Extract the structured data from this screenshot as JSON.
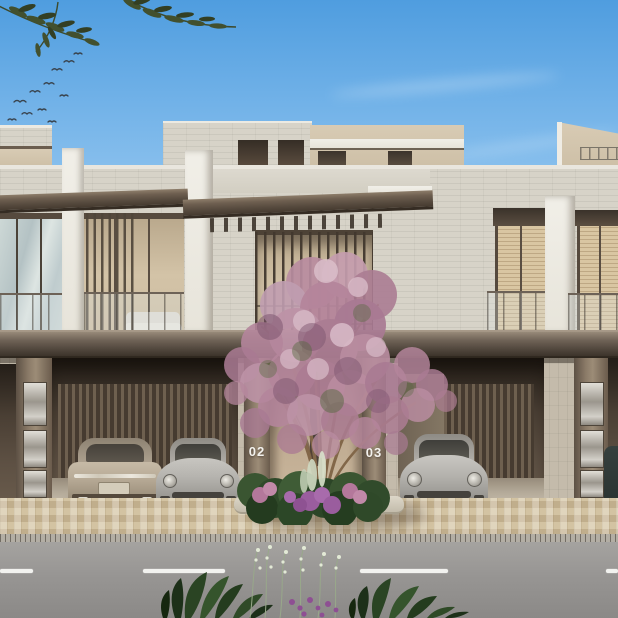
{
  "scene": {
    "setting": "Daytime architectural rendering of a row of modern stone-clad townhouses with open carports, a central entrance flanked by numbered pillars, a pink blossom tree, a paved driveway and an asphalt road in the foreground",
    "units": [
      {
        "number": "02"
      },
      {
        "number": "03"
      }
    ],
    "objects": [
      "sky",
      "clouds",
      "flying-birds",
      "olive-branches",
      "townhouse-facade",
      "rooftop-terrace",
      "pergola-canopy",
      "bronze-slat-screens",
      "glass-balustrades",
      "carport-garages",
      "champagne-coupe-rear",
      "silver-sports-car",
      "silver-sports-car-2",
      "dark-car-partial",
      "blossom-tree",
      "entrance-planter",
      "paver-driveway",
      "drainage-channel",
      "asphalt-road",
      "lane-markings",
      "foreground-plants"
    ]
  },
  "colors": {
    "sky-top": "#4f9ddf",
    "sky-mid": "#9ccbf0",
    "sky-bottom": "#cfe6f7",
    "cloud-white": "#ffffff",
    "stone-light": "#d7d3c8",
    "stone-ground": "#c4bbab",
    "beige-volume": "#d8cbb4",
    "white-trim": "#e7e4da",
    "canopy-dark": "#55493d",
    "garage-wood": "#6e604f",
    "interior-warm": "#d3c3a7",
    "blind-beige": "#d9c6a2",
    "metal-panel": "#d3d0c9",
    "blossom-pink": "#b98ca0",
    "blossom-light": "#d8bac7",
    "blossom-deep": "#8f5f78",
    "planter-green": "#2f4929",
    "flower-purple": "#9a5d9e",
    "paver-beige": "#d3c3a2",
    "road-gray": "#979593",
    "lane-white": "#f2f2ef",
    "car-champagne": "#b9ac98",
    "car-silver": "#b5b3ae",
    "label-white": "#f4f2ee"
  }
}
